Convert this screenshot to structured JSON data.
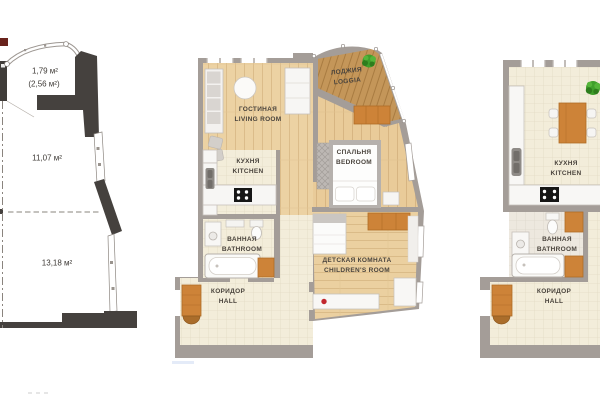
{
  "plans": {
    "outline": {
      "areas": {
        "balcony": "1,79 м²",
        "balcony_total": "(2,56 м²)",
        "room_upper": "11,07 м²",
        "room_lower": "13,18 м²"
      }
    },
    "two_room": {
      "rooms": {
        "living": {
          "ru": "ГОСТИНАЯ",
          "en": "LIVING ROOM"
        },
        "loggia": {
          "ru": "ЛОДЖИЯ",
          "en": "LOGGIA"
        },
        "kitchen": {
          "ru": "КУХНЯ",
          "en": "KITCHEN"
        },
        "bedroom": {
          "ru": "СПАЛЬНЯ",
          "en": "BEDROOM"
        },
        "bathroom": {
          "ru": "ВАННАЯ",
          "en": "BATHROOM"
        },
        "children": {
          "ru": "ДЕТСКАЯ КОМНАТА",
          "en": "CHILDREN'S ROOM"
        },
        "hall": {
          "ru": "КОРИДОР",
          "en": "HALL"
        }
      }
    },
    "studio": {
      "rooms": {
        "kitchen": {
          "ru": "КУХНЯ",
          "en": "KITCHEN"
        },
        "bathroom": {
          "ru": "ВАННАЯ",
          "en": "BATHROOM"
        },
        "hall": {
          "ru": "КОРИДОР",
          "en": "HALL"
        }
      }
    }
  },
  "colors": {
    "wall": "#a49d98",
    "wall_dark": "#45413e",
    "wood_floor": "#ecd2a3",
    "loggia_wood": "#c49659",
    "tile": "#f3edda",
    "cabinet_wood": "#cd8338",
    "plant": "#3f9f2b",
    "accent_red": "#c1272d",
    "label_text": "#4a443d"
  }
}
